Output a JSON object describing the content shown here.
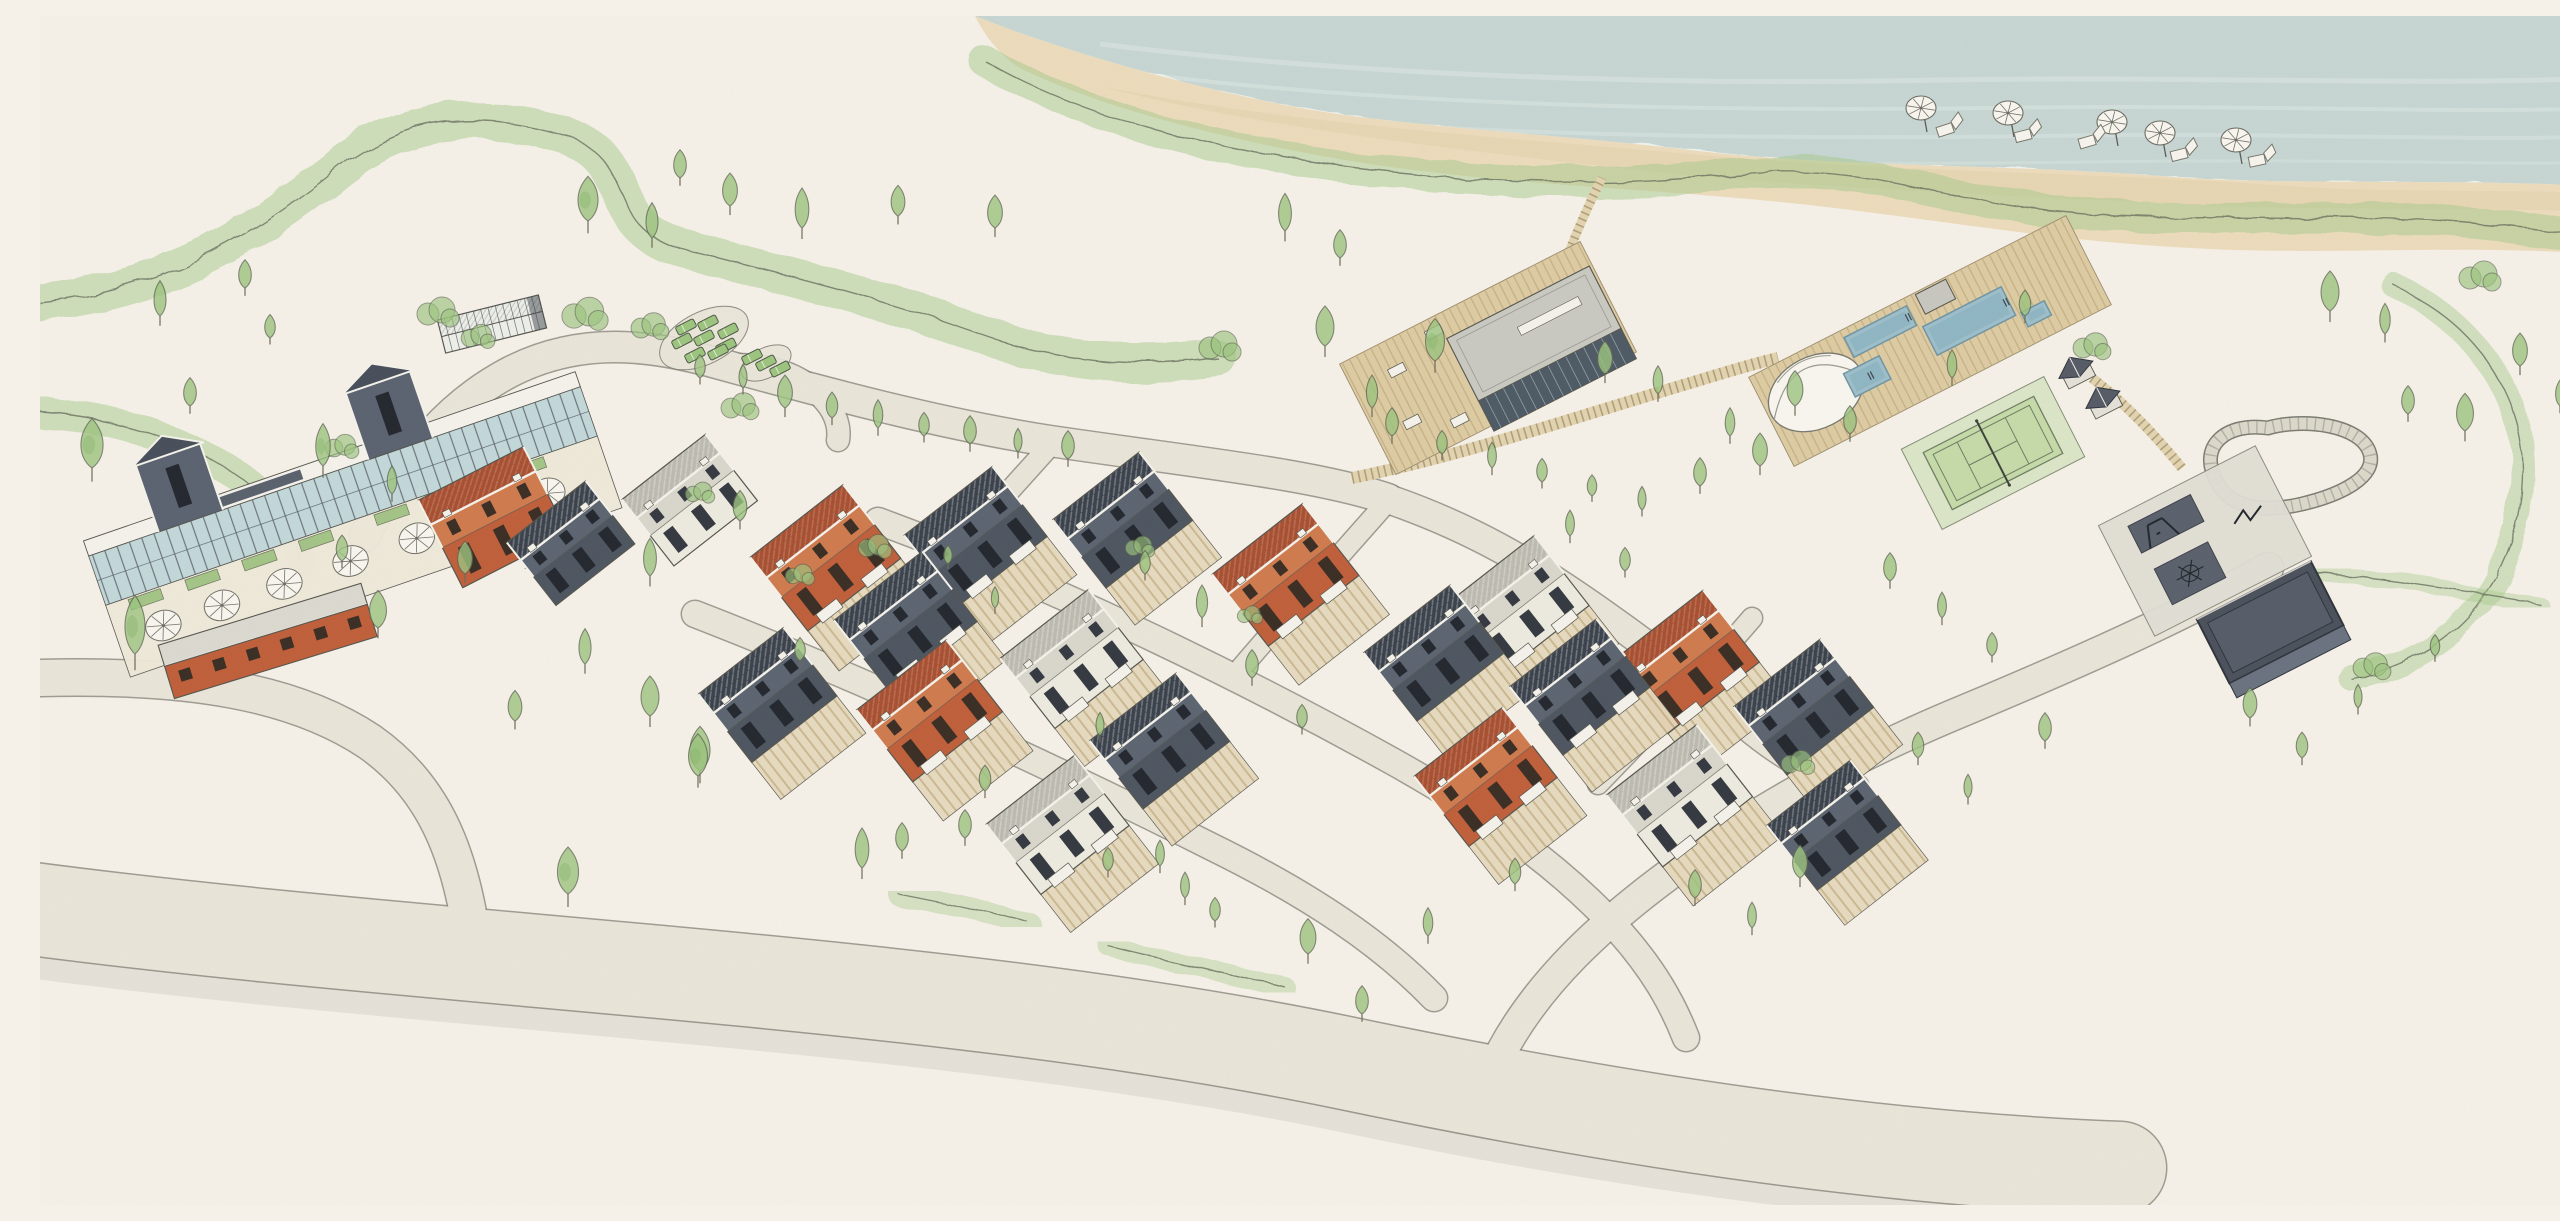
{
  "meta": {
    "width": 2560,
    "height": 1189,
    "description": "Hand-drawn watercolor aerial masterplan of a seaside residential resort: beach with umbrellas, dunes, clubhouse, greenhouse, parking, townhouse clusters in terracotta, slate and white, community pavilion on a deck, pool complex with canopy, tennis court, playground, pump track and barn, connected by curving roads."
  },
  "palette": {
    "background": "#f6f1e8",
    "ocean": "#bccfcd",
    "oceanStreak": "#dde8e4",
    "foam": "#f4f6f1",
    "sand": "#ecdcbc",
    "sandShade": "#e0cda6",
    "band": "#a6ca8c",
    "duneLine": "#6a7260",
    "tree": "#9cc47f",
    "treeDark": "#7fae62",
    "treeEdge": "#5f6853",
    "roadFill": "#eae5d9",
    "roadEdge": "#807f75",
    "roadWash": "#d6d2c7",
    "boardwalk": "#e3d4b0",
    "boardwalkTick": "#a3916c",
    "deck": "#ddcba2",
    "deckLine": "#bfa97f",
    "pool": "#9dbfca",
    "poolDeep": "#85aebd",
    "poolEdge": "#6f95a3",
    "glass": "#c3d8da",
    "mullion": "#5a626b",
    "trim": "#f4f2ea",
    "ink": "#55554e",
    "terrace": "#e6d9bd",
    "terraceLine": "#c9b78e",
    "mat": "#5a616c",
    "car": "#9cc57e",
    "carEdge": "#4f5a48",
    "umbrella": "#f8f6ee",
    "umbRib": "#72726a",
    "furn": "#f6f4ed",
    "barnTop": "#4b515c",
    "barnMid": "#565c68",
    "barnFront": "#6a7280",
    "courtGreen": "#c6daa9",
    "courtApron": "#d7e3c2",
    "courtLine": "#6f7f63",
    "netDark": "#3c423a",
    "padConcrete": "#e1dfd5",
    "pavilionRoof": "#c9c9c2",
    "pavilionGlass": "#4e5a64",
    "greenhouseGlass": "#edefe8",
    "houses": {
      "orange": {
        "back": "#a84f30",
        "front": "#cf7a4e",
        "wall": "#c05f3a",
        "win": "#3a2d24"
      },
      "slate": {
        "back": "#3a414b",
        "front": "#5b6470",
        "wall": "#4d5560",
        "win": "#23272e"
      },
      "white": {
        "back": "#bdbbb0",
        "front": "#d9d7cc",
        "wall": "#edebdf",
        "win": "#343840"
      }
    }
  },
  "scene": {
    "houses": [
      {
        "x": 455,
        "y": 505,
        "a": -27,
        "w": 118,
        "d": 86,
        "c": "orange",
        "t": 0,
        "b": 0
      },
      {
        "x": 533,
        "y": 530,
        "a": -38,
        "w": 100,
        "d": 70,
        "c": "slate",
        "t": 0,
        "b": 0
      },
      {
        "x": 652,
        "y": 487,
        "a": -38,
        "w": 106,
        "d": 74,
        "c": "white",
        "t": 0,
        "b": 0
      },
      {
        "x": 228,
        "y": 626,
        "a": -17,
        "w": 212,
        "d": 58,
        "c": "orange",
        "t": 0,
        "b": 0,
        "s": "slab"
      },
      {
        "x": 788,
        "y": 545,
        "a": -38,
        "w": 118,
        "d": 82,
        "c": "orange",
        "t": 1,
        "b": 1
      },
      {
        "x": 938,
        "y": 523,
        "a": -38,
        "w": 112,
        "d": 78,
        "c": "slate",
        "t": 1,
        "b": 1
      },
      {
        "x": 1085,
        "y": 507,
        "a": -38,
        "w": 110,
        "d": 76,
        "c": "slate",
        "t": 1,
        "b": 0
      },
      {
        "x": 1248,
        "y": 562,
        "a": -38,
        "w": 115,
        "d": 80,
        "c": "orange",
        "t": 1,
        "b": 1
      },
      {
        "x": 730,
        "y": 682,
        "a": -38,
        "w": 108,
        "d": 76,
        "c": "slate",
        "t": 1,
        "b": 0
      },
      {
        "x": 868,
        "y": 608,
        "a": -38,
        "w": 112,
        "d": 78,
        "c": "slate",
        "t": 1,
        "b": 1
      },
      {
        "x": 892,
        "y": 698,
        "a": -38,
        "w": 114,
        "d": 80,
        "c": "orange",
        "t": 1,
        "b": 1
      },
      {
        "x": 1034,
        "y": 646,
        "a": -38,
        "w": 112,
        "d": 78,
        "c": "white",
        "t": 1,
        "b": 1
      },
      {
        "x": 1122,
        "y": 728,
        "a": -38,
        "w": 110,
        "d": 76,
        "c": "slate",
        "t": 1,
        "b": 0
      },
      {
        "x": 1020,
        "y": 812,
        "a": -38,
        "w": 112,
        "d": 78,
        "c": "white",
        "t": 1,
        "b": 1
      },
      {
        "x": 1396,
        "y": 640,
        "a": -38,
        "w": 110,
        "d": 76,
        "c": "slate",
        "t": 1,
        "b": 0
      },
      {
        "x": 1480,
        "y": 592,
        "a": -38,
        "w": 112,
        "d": 78,
        "c": "white",
        "t": 1,
        "b": 1
      },
      {
        "x": 1542,
        "y": 674,
        "a": -38,
        "w": 110,
        "d": 76,
        "c": "slate",
        "t": 1,
        "b": 1
      },
      {
        "x": 1648,
        "y": 649,
        "a": -38,
        "w": 116,
        "d": 80,
        "c": "orange",
        "t": 1,
        "b": 1
      },
      {
        "x": 1766,
        "y": 694,
        "a": -38,
        "w": 110,
        "d": 76,
        "c": "slate",
        "t": 1,
        "b": 0
      },
      {
        "x": 1448,
        "y": 764,
        "a": -38,
        "w": 112,
        "d": 78,
        "c": "orange",
        "t": 1,
        "b": 1
      },
      {
        "x": 1642,
        "y": 783,
        "a": -38,
        "w": 114,
        "d": 80,
        "c": "white",
        "t": 1,
        "b": 1
      },
      {
        "x": 1796,
        "y": 812,
        "a": -38,
        "w": 106,
        "d": 72,
        "c": "slate",
        "t": 1,
        "b": 0
      }
    ],
    "trees": [
      [
        52,
        452,
        1.05
      ],
      [
        95,
        638,
        1.25
      ],
      [
        150,
        390,
        0.6
      ],
      [
        230,
        322,
        0.5
      ],
      [
        283,
        450,
        0.9
      ],
      [
        302,
        545,
        0.55
      ],
      [
        338,
        612,
        0.8
      ],
      [
        352,
        478,
        0.6
      ],
      [
        425,
        558,
        0.7
      ],
      [
        475,
        705,
        0.65
      ],
      [
        545,
        648,
        0.75
      ],
      [
        610,
        700,
        0.85
      ],
      [
        660,
        755,
        0.95
      ],
      [
        120,
        300,
        0.75
      ],
      [
        205,
        272,
        0.6
      ],
      [
        548,
        205,
        0.95
      ],
      [
        612,
        222,
        0.75
      ],
      [
        640,
        162,
        0.6
      ],
      [
        690,
        190,
        0.7
      ],
      [
        762,
        212,
        0.85
      ],
      [
        858,
        200,
        0.65
      ],
      [
        955,
        212,
        0.7
      ],
      [
        1245,
        215,
        0.8
      ],
      [
        1300,
        242,
        0.6
      ],
      [
        660,
        362,
        0.5
      ],
      [
        703,
        372,
        0.5
      ],
      [
        745,
        392,
        0.7
      ],
      [
        792,
        402,
        0.55
      ],
      [
        838,
        412,
        0.6
      ],
      [
        884,
        420,
        0.5
      ],
      [
        930,
        428,
        0.6
      ],
      [
        978,
        436,
        0.5
      ],
      [
        1028,
        443,
        0.6
      ],
      [
        700,
        505,
        0.65
      ],
      [
        610,
        560,
        0.8
      ],
      [
        658,
        760,
        0.9
      ],
      [
        760,
        645,
        0.5
      ],
      [
        955,
        592,
        0.45
      ],
      [
        908,
        548,
        0.4
      ],
      [
        1105,
        558,
        0.5
      ],
      [
        1162,
        602,
        0.7
      ],
      [
        1212,
        662,
        0.6
      ],
      [
        1262,
        712,
        0.5
      ],
      [
        1060,
        720,
        0.5
      ],
      [
        945,
        775,
        0.55
      ],
      [
        862,
        835,
        0.6
      ],
      [
        1120,
        850,
        0.55
      ],
      [
        1175,
        905,
        0.5
      ],
      [
        1285,
        330,
        0.85
      ],
      [
        1332,
        392,
        0.7
      ],
      [
        1395,
        345,
        0.9
      ],
      [
        1565,
        358,
        0.7
      ],
      [
        1618,
        378,
        0.6
      ],
      [
        1352,
        420,
        0.6
      ],
      [
        1402,
        438,
        0.5
      ],
      [
        1452,
        452,
        0.55
      ],
      [
        1502,
        466,
        0.5
      ],
      [
        1552,
        480,
        0.45
      ],
      [
        1602,
        494,
        0.5
      ],
      [
        1660,
        470,
        0.6
      ],
      [
        1720,
        450,
        0.7
      ],
      [
        1690,
        420,
        0.6
      ],
      [
        1755,
        390,
        0.75
      ],
      [
        1810,
        418,
        0.6
      ],
      [
        1912,
        362,
        0.6
      ],
      [
        1985,
        300,
        0.55
      ],
      [
        2290,
        295,
        0.85
      ],
      [
        2345,
        318,
        0.65
      ],
      [
        2425,
        415,
        0.8
      ],
      [
        2480,
        350,
        0.7
      ],
      [
        2520,
        390,
        0.55
      ],
      [
        2368,
        398,
        0.6
      ],
      [
        1850,
        565,
        0.6
      ],
      [
        1902,
        602,
        0.55
      ],
      [
        1952,
        640,
        0.5
      ],
      [
        1878,
        742,
        0.55
      ],
      [
        1928,
        782,
        0.5
      ],
      [
        2005,
        725,
        0.6
      ],
      [
        1585,
        555,
        0.5
      ],
      [
        1530,
        520,
        0.55
      ],
      [
        2210,
        702,
        0.65
      ],
      [
        2262,
        742,
        0.55
      ],
      [
        2318,
        692,
        0.5
      ],
      [
        2395,
        640,
        0.45
      ],
      [
        528,
        878,
        1.0
      ],
      [
        822,
        852,
        0.85
      ],
      [
        925,
        822,
        0.6
      ],
      [
        1068,
        855,
        0.5
      ],
      [
        1145,
        882,
        0.55
      ],
      [
        1268,
        938,
        0.75
      ],
      [
        1322,
        998,
        0.6
      ],
      [
        1388,
        920,
        0.6
      ],
      [
        1475,
        868,
        0.55
      ],
      [
        1655,
        882,
        0.6
      ],
      [
        1712,
        912,
        0.55
      ],
      [
        1760,
        862,
        0.7
      ]
    ],
    "bushes": [
      [
        398,
        298,
        1
      ],
      [
        438,
        322,
        0.8
      ],
      [
        545,
        300,
        1.1
      ],
      [
        610,
        312,
        0.9
      ],
      [
        700,
        392,
        0.9
      ],
      [
        1180,
        332,
        1
      ],
      [
        835,
        532,
        0.8
      ],
      [
        1100,
        532,
        0.7
      ],
      [
        2052,
        332,
        0.9
      ],
      [
        2440,
        262,
        1
      ],
      [
        302,
        432,
        0.8
      ],
      [
        660,
        478,
        0.7
      ],
      [
        1758,
        748,
        0.8
      ],
      [
        2332,
        652,
        0.9
      ],
      [
        760,
        560,
        0.7
      ],
      [
        1210,
        600,
        0.6
      ]
    ],
    "cars": [
      [
        646,
        311
      ],
      [
        668,
        307
      ],
      [
        688,
        315
      ],
      [
        642,
        325
      ],
      [
        664,
        322
      ],
      [
        686,
        330
      ],
      [
        655,
        339
      ],
      [
        678,
        336
      ],
      [
        712,
        341
      ],
      [
        726,
        347
      ],
      [
        740,
        353
      ]
    ],
    "umbrellas": [
      [
        1881,
        92
      ],
      [
        1968,
        97
      ],
      [
        2072,
        106
      ],
      [
        2120,
        117
      ],
      [
        2196,
        124
      ]
    ],
    "loungers": [
      [
        1908,
        113,
        -18
      ],
      [
        1986,
        119,
        -14
      ],
      [
        2050,
        125,
        -16
      ],
      [
        2142,
        138,
        -14
      ],
      [
        2220,
        144,
        -12
      ]
    ],
    "amenities": {
      "clubhouse": {
        "x": 305,
        "y": 492,
        "a": -19
      },
      "greenhouse": {
        "x": 452,
        "y": 308,
        "a": -14
      },
      "deckPavilion": {
        "x": 1448,
        "y": 342,
        "a": -27
      },
      "poolComplex": {
        "x": 1890,
        "y": 325,
        "a": -27,
        "pools": [
          [
            -75,
            -42,
            70,
            22
          ],
          [
            0,
            -16,
            88,
            32
          ],
          [
            -92,
            -10,
            40,
            26
          ],
          [
            94,
            16,
            26,
            16
          ]
        ],
        "box": [
          8,
          -48,
          34,
          22
        ]
      },
      "huts": [
        [
          2035,
          352
        ],
        [
          2062,
          382
        ]
      ],
      "tennis": {
        "x": 1953,
        "y": 437,
        "a": -27
      },
      "playground": {
        "x": 2165,
        "y": 525,
        "a": -27
      },
      "pumpTrack": {
        "x": 2253,
        "y": 447
      },
      "barn": {
        "x": 2232,
        "y": 610,
        "a": -27
      }
    }
  }
}
